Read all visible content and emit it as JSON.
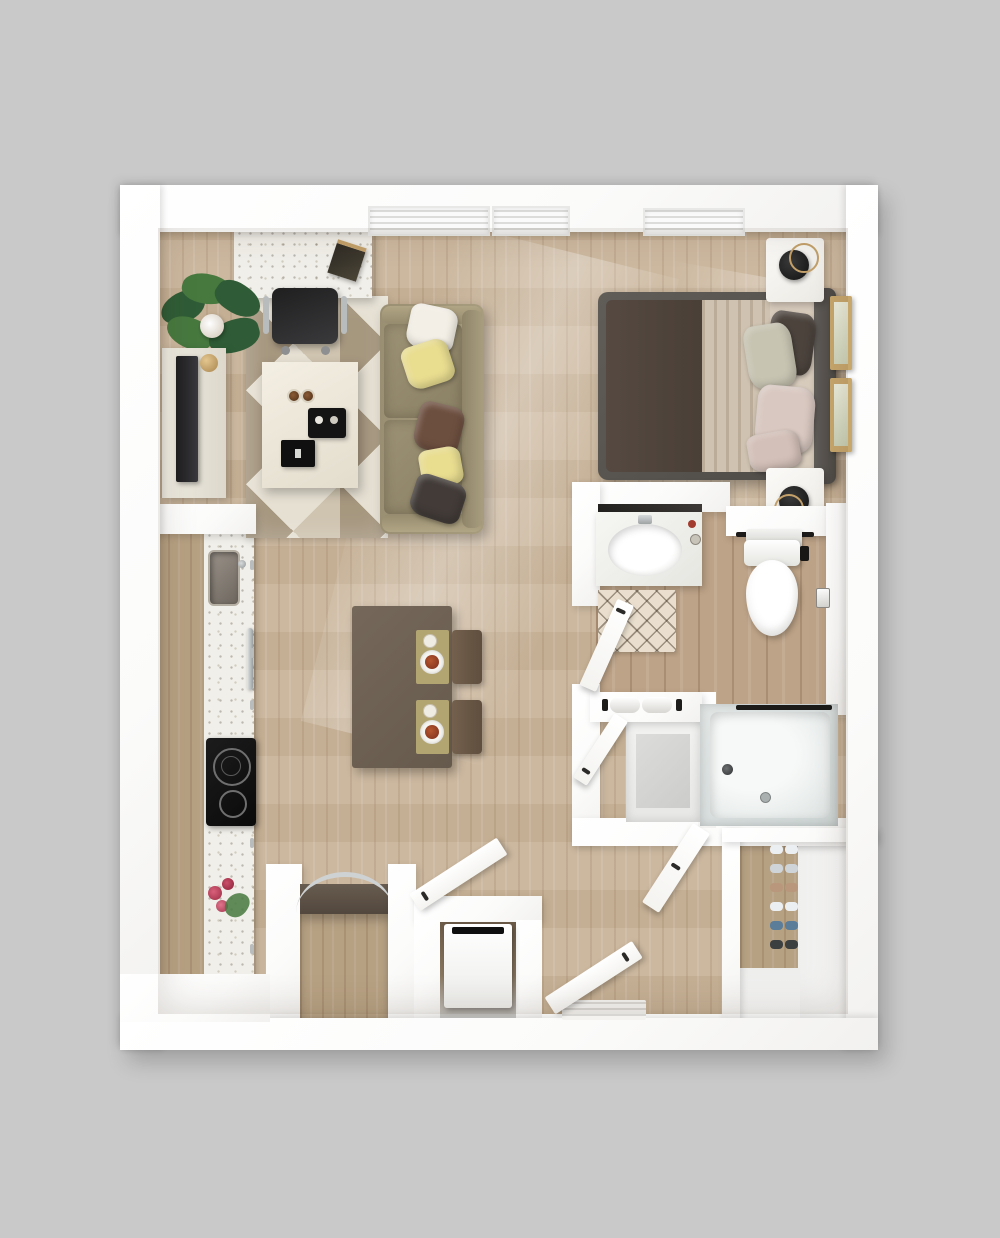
{
  "scene": {
    "kind": "apartment-floor-plan-3d-render",
    "view": "top-down",
    "text_labels": "none"
  },
  "palette": {
    "bg": "#c9c9c9",
    "wall": "#ffffff",
    "floor-wood": "#c9b499",
    "kitchen-floor": "#b7a183",
    "bath-floor": "#bda387",
    "rug-light": "#e6e0d3",
    "rug-mid": "#cfc4b0",
    "rug-dark": "#a6977f",
    "sofa": "#a njk",
    "sofa-base": "#a0957a",
    "sofa-cushion": "#948a6d",
    "pillow-white": "#f3efe6",
    "pillow-yellow": "#e9dd90",
    "pillow-brown": "#6d4f3f",
    "pillow-charcoal": "#423b38",
    "bed-frame": "#5a5651",
    "blanket": "#4f443c",
    "sheet": "#cfc2b0",
    "pillow-pink": "#d9c8c1",
    "pillow-sage": "#c8c4b2",
    "clock-face": "#1d1c1b",
    "gold": "#c3a06a",
    "frame-tan": "#c8a76d",
    "art-paper": "#e9ead9",
    "table-top": "#6e6154",
    "chair-brown": "#6a5847",
    "placemat-olive": "#b3a571",
    "food": "#93402a",
    "counter-speckle": "#f1efe9",
    "cooktop": "#161616",
    "steel": "#c2c6c7",
    "tub": "#dde3e2",
    "tub-inner": "#eef1f0",
    "marble": "#f3f3ef",
    "bathmat": "#eadfce",
    "dark-counter": "#5d5148",
    "plant-green": "#2f5c36",
    "plant-green-light": "#47793f",
    "tv-screen": "#2a2a2c",
    "console": "#e9e5da",
    "flower-red": "#c2465a",
    "shoe-gray": "#cfd4d8",
    "shoe-white": "#eceff1",
    "shoe-blue": "#5b7d99",
    "shoe-tan": "#b9977c"
  },
  "rooms": [
    {
      "name": "living-room",
      "furniture": [
        "desk",
        "desk-notebook",
        "office-chair",
        "potted-plant",
        "tv-console",
        "tv",
        "area-rug",
        "coffee-table",
        "sofa",
        "throw-pillows"
      ]
    },
    {
      "name": "bedroom",
      "furniture": [
        "queen-bed",
        "headboard",
        "nightstand-top",
        "nightstand-bottom",
        "alarm-clock-top",
        "alarm-clock-bottom",
        "wall-art-1",
        "wall-art-2"
      ]
    },
    {
      "name": "kitchen",
      "furniture": [
        "counter-run",
        "kitchen-sink",
        "oven-handle",
        "cooktop",
        "flower-vase",
        "pass-through-counter",
        "cabinet-arc-handle",
        "washer-dryer"
      ]
    },
    {
      "name": "dining-area",
      "furniture": [
        "dining-table",
        "place-setting-1",
        "place-setting-2",
        "dining-chair-1",
        "dining-chair-2"
      ]
    },
    {
      "name": "bathroom",
      "furniture": [
        "vanity-sink",
        "mirror",
        "bath-mat",
        "toilet",
        "towel-bar",
        "toilet-paper-holder",
        "bathtub",
        "towel-shelf",
        "linen-closet"
      ]
    },
    {
      "name": "entry",
      "furniture": [
        "entry-door",
        "entry-mat",
        "coat-closet-door",
        "shoe-closet",
        "laundry-door",
        "bathroom-door",
        "linen-door"
      ]
    }
  ],
  "windows": {
    "count": 3,
    "location": "top-wall"
  }
}
